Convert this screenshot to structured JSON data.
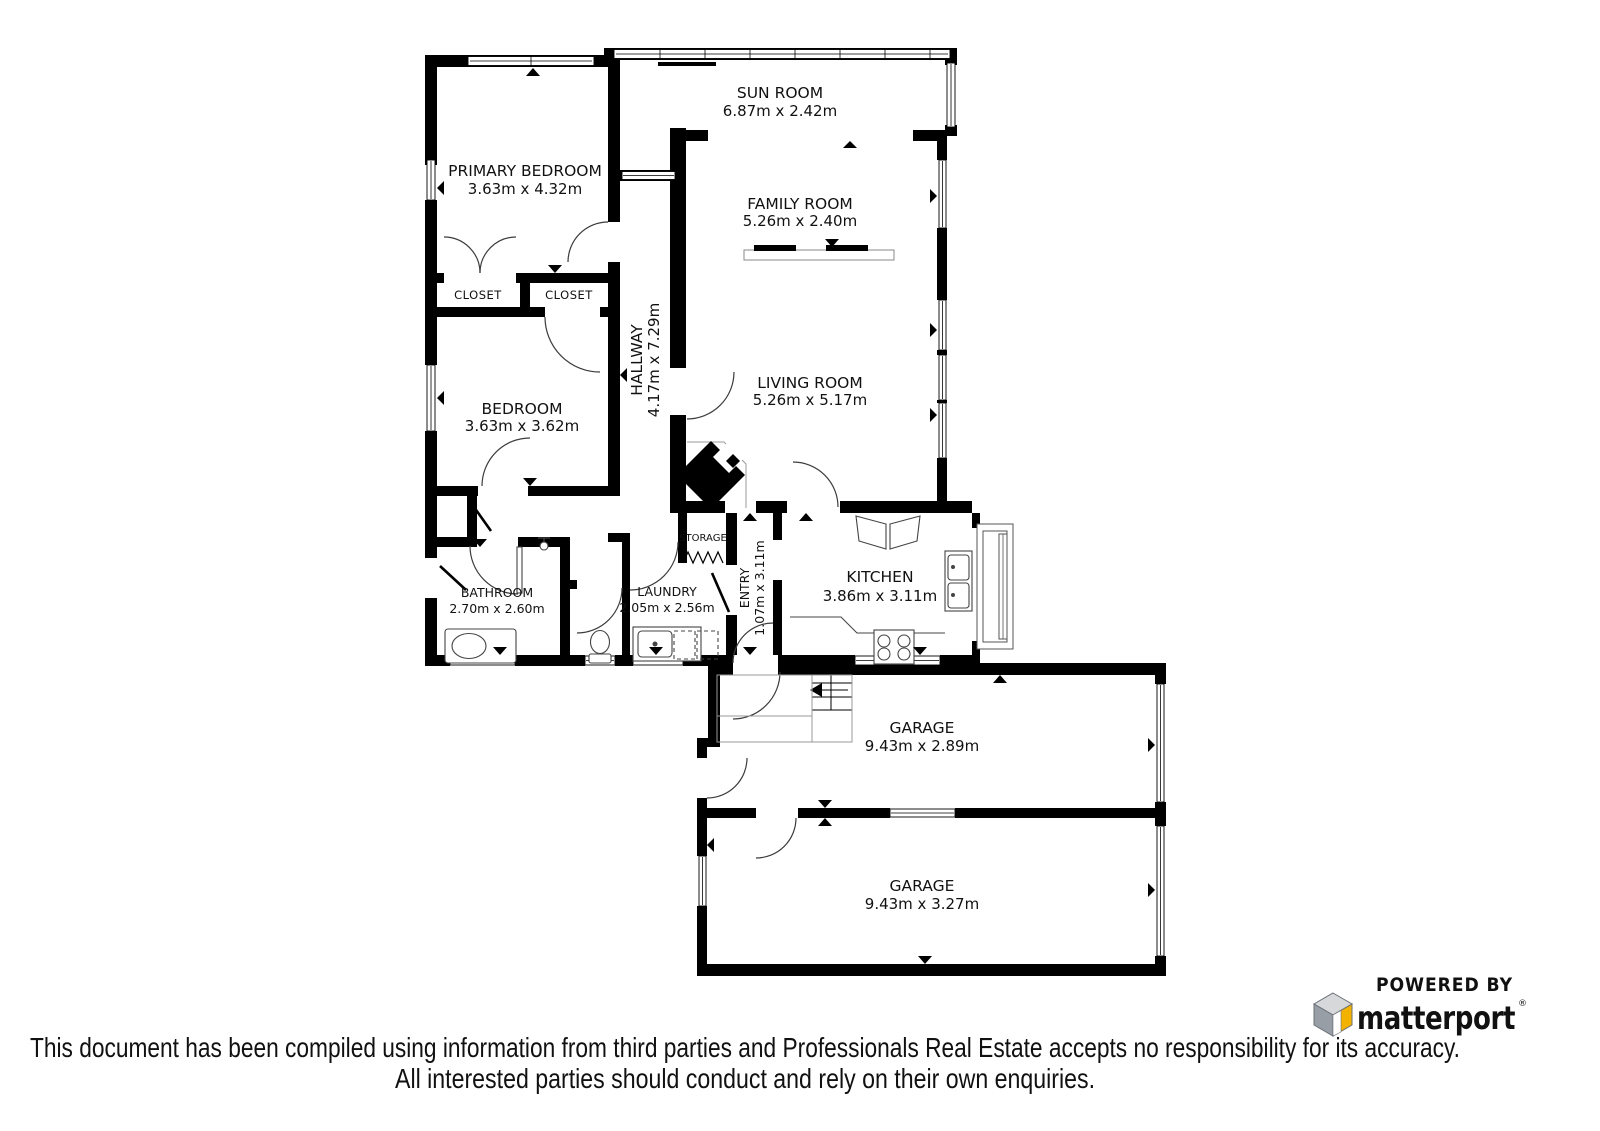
{
  "floorplan": {
    "wall_color": "#000000",
    "rooms": {
      "sun_room": {
        "name": "SUN ROOM",
        "dims": "6.87m x 2.42m"
      },
      "primary_bedroom": {
        "name": "PRIMARY BEDROOM",
        "dims": "3.63m x 4.32m"
      },
      "family_room": {
        "name": "FAMILY ROOM",
        "dims": "5.26m x 2.40m"
      },
      "living_room": {
        "name": "LIVING ROOM",
        "dims": "5.26m x 5.17m"
      },
      "hallway": {
        "name": "HALLWAY",
        "dims": "4.17m x 7.29m"
      },
      "closet_left": {
        "name": "CLOSET"
      },
      "closet_right": {
        "name": "CLOSET"
      },
      "bedroom": {
        "name": "BEDROOM",
        "dims": "3.63m x 3.62m"
      },
      "bathroom": {
        "name": "BATHROOM",
        "dims": "2.70m x 2.60m"
      },
      "laundry": {
        "name": "LAUNDRY",
        "dims": "2.05m x 2.56m"
      },
      "storage": {
        "name": "STORAGE"
      },
      "entry": {
        "name": "ENTRY",
        "dims": "1.07m x 3.11m"
      },
      "kitchen": {
        "name": "KITCHEN",
        "dims": "3.86m x 3.11m"
      },
      "garage_upper": {
        "name": "GARAGE",
        "dims": "9.43m x 2.89m"
      },
      "garage_lower": {
        "name": "GARAGE",
        "dims": "9.43m x 3.27m"
      }
    }
  },
  "branding": {
    "powered_by": "POWERED BY",
    "brand_name": "matterport",
    "registered_mark": "®",
    "brand_color": "#1a3d5c",
    "cube": {
      "top": "#d6d8da",
      "left": "#989ea5",
      "right": "#f3b200",
      "outline": "#6a7077"
    }
  },
  "disclaimer": {
    "line1": "This document has been compiled using information from third parties and Professionals Real Estate accepts no responsibility for its accuracy.",
    "line2": "All interested parties should conduct and rely on their own enquiries.",
    "color": "#3f3f3f"
  }
}
